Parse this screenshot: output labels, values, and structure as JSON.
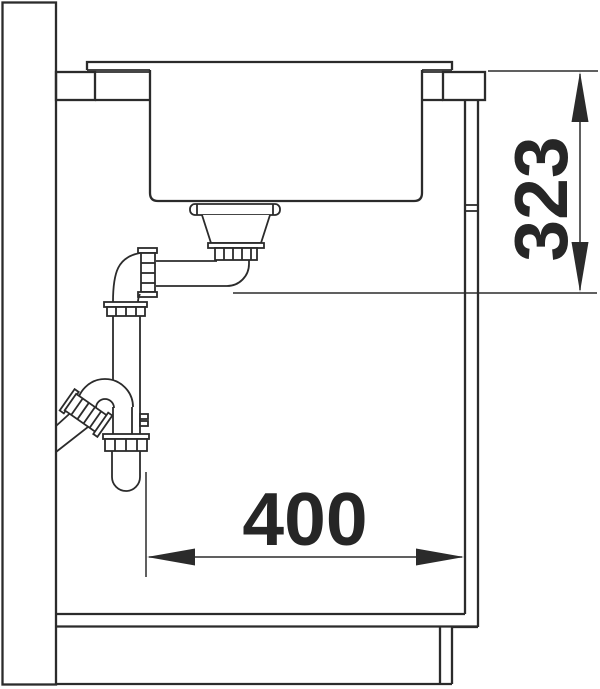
{
  "diagram": {
    "background_color": "#ffffff",
    "line_color": "#2b2b2b",
    "dimensions": {
      "vertical": {
        "value": "323",
        "orientation": "vertical"
      },
      "horizontal": {
        "value": "400",
        "orientation": "horizontal"
      }
    }
  }
}
